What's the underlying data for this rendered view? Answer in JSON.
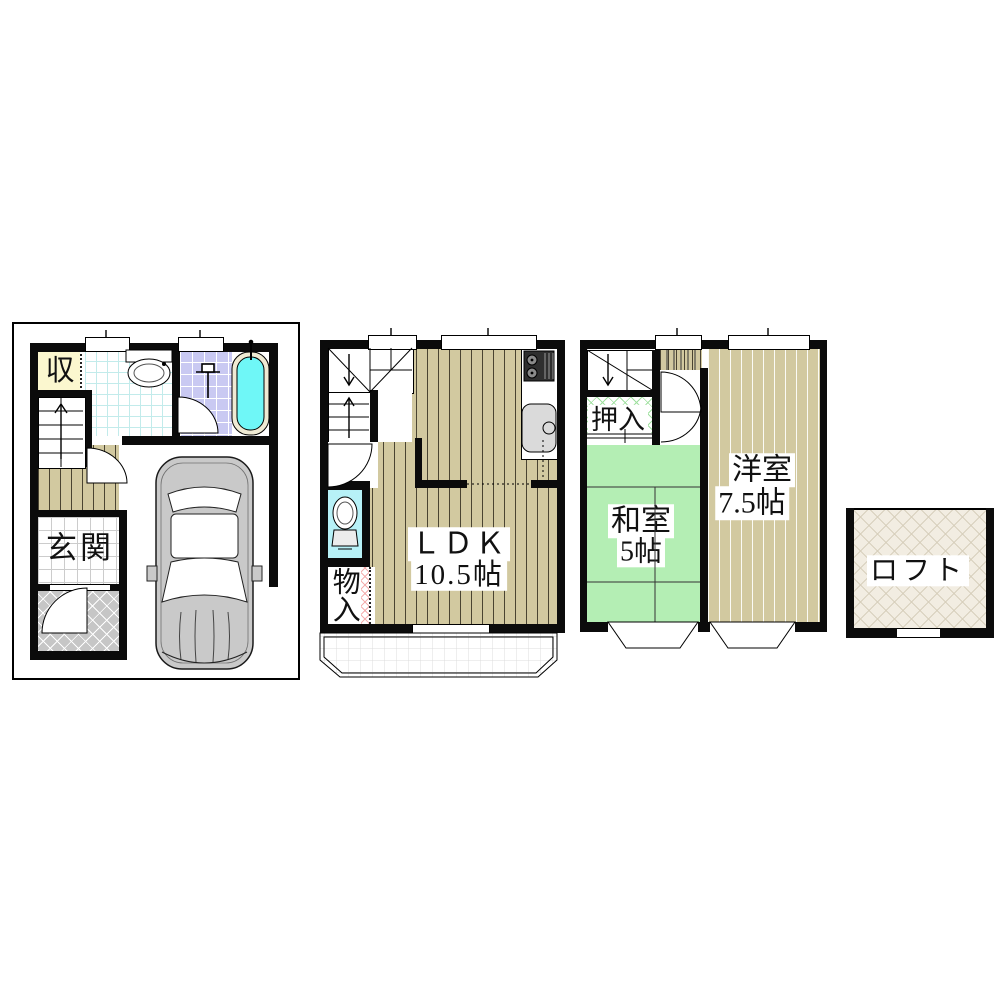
{
  "floors": {
    "f1": {
      "storage": "収",
      "entrance": "玄関"
    },
    "f2": {
      "ldk": "ＬＤＫ",
      "ldk_size": "10.5帖",
      "closet": "物入",
      "balcony": "バルコニー"
    },
    "f3": {
      "closet": "押入",
      "jp_room": "和室",
      "jp_room_size": "5帖",
      "west_room": "洋室",
      "west_room_size": "7.5帖"
    },
    "loft": {
      "label": "ロフト"
    }
  },
  "colors": {
    "wood_floor": "#D2C9A0",
    "tatami_green": "#B4EEB4",
    "toilet_room_cyan": "#B7F1F7",
    "bath_tile_purple": "#C9C9F2",
    "tub_water_cyan": "#6FF7F7",
    "tub_rim_cream": "#EFEAD3",
    "storage_yellow": "#FBF7CF",
    "porch_gray": "#C6C6C6",
    "loft_beige": "#F2EDE2",
    "closet_lattice_green": "#9FE09F",
    "closet_zigzag_pink": "#F5AFAF",
    "car_gray": "#C9C9C9",
    "wall_black": "#0B0B0B"
  }
}
